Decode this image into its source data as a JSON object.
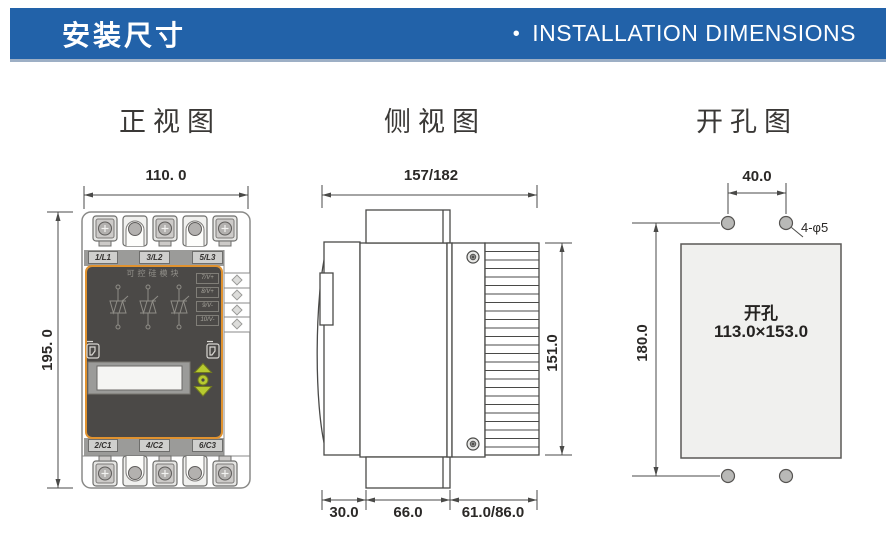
{
  "header": {
    "title_zh": "安装尺寸",
    "bullet": "•",
    "title_en": "INSTALLATION DIMENSIONS"
  },
  "colors": {
    "header_bg": "#2262a9",
    "panel_dark": "#4b4947",
    "panel_accent_orange": "#e0922f",
    "button_green": "#b7ca2f",
    "drawing_line": "#4a4a48"
  },
  "views": {
    "front": {
      "title": "正视图",
      "width_dim": "110. 0",
      "height_dim": "195. 0",
      "device": {
        "top_terminal_labels": [
          "1/L1",
          "3/L2",
          "5/L3"
        ],
        "bottom_terminal_labels": [
          "2/C1",
          "4/C2",
          "6/C3"
        ],
        "panel_title": "可控硅模块",
        "gate_terminal_labels": [
          "7/V+",
          "8/V+",
          "9/V-",
          "10/V-"
        ]
      }
    },
    "side": {
      "title": "侧视图",
      "width_dim": "157/182",
      "height_dim": "151.0",
      "bottom_dims": [
        "30.0",
        "66.0",
        "61.0/86.0"
      ]
    },
    "cutout": {
      "title": "开孔图",
      "hole_spacing_dim": "40.0",
      "height_dim": "180.0",
      "hole_spec": "4-φ5",
      "cutout_label_line1": "开孔",
      "cutout_label_line2": "113.0×153.0"
    }
  }
}
